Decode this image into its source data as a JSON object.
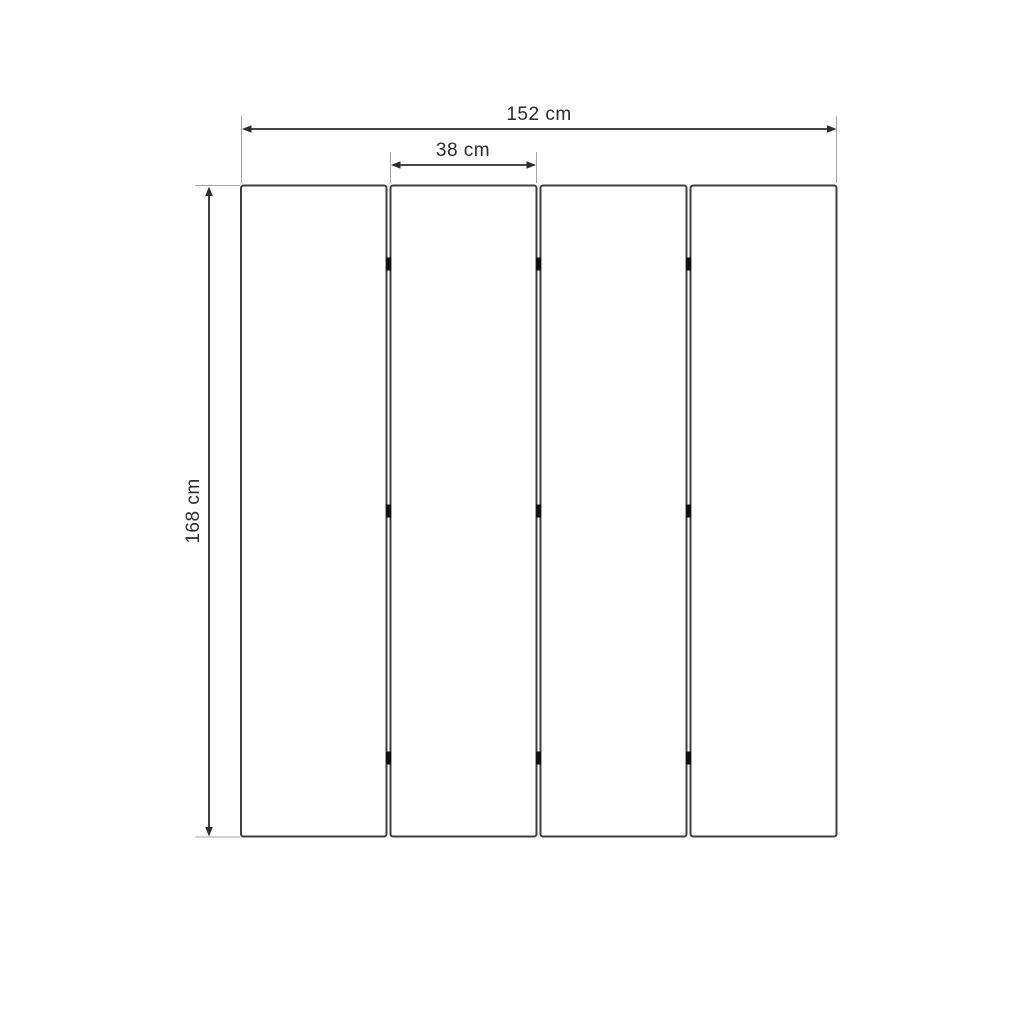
{
  "diagram": {
    "type": "dimension-diagram",
    "subject": "four-panel folding screen, front view",
    "panel_count": 4,
    "hinge_rows": 3,
    "labels": {
      "total_width": "152 cm",
      "panel_width": "38 cm",
      "height": "168 cm"
    },
    "colors": {
      "background": "#ffffff",
      "panel_outline": "#3f3f3f",
      "dimension": "#2d2d2d",
      "extension_line": "#a3a3a3",
      "hinge": "#111111"
    }
  }
}
